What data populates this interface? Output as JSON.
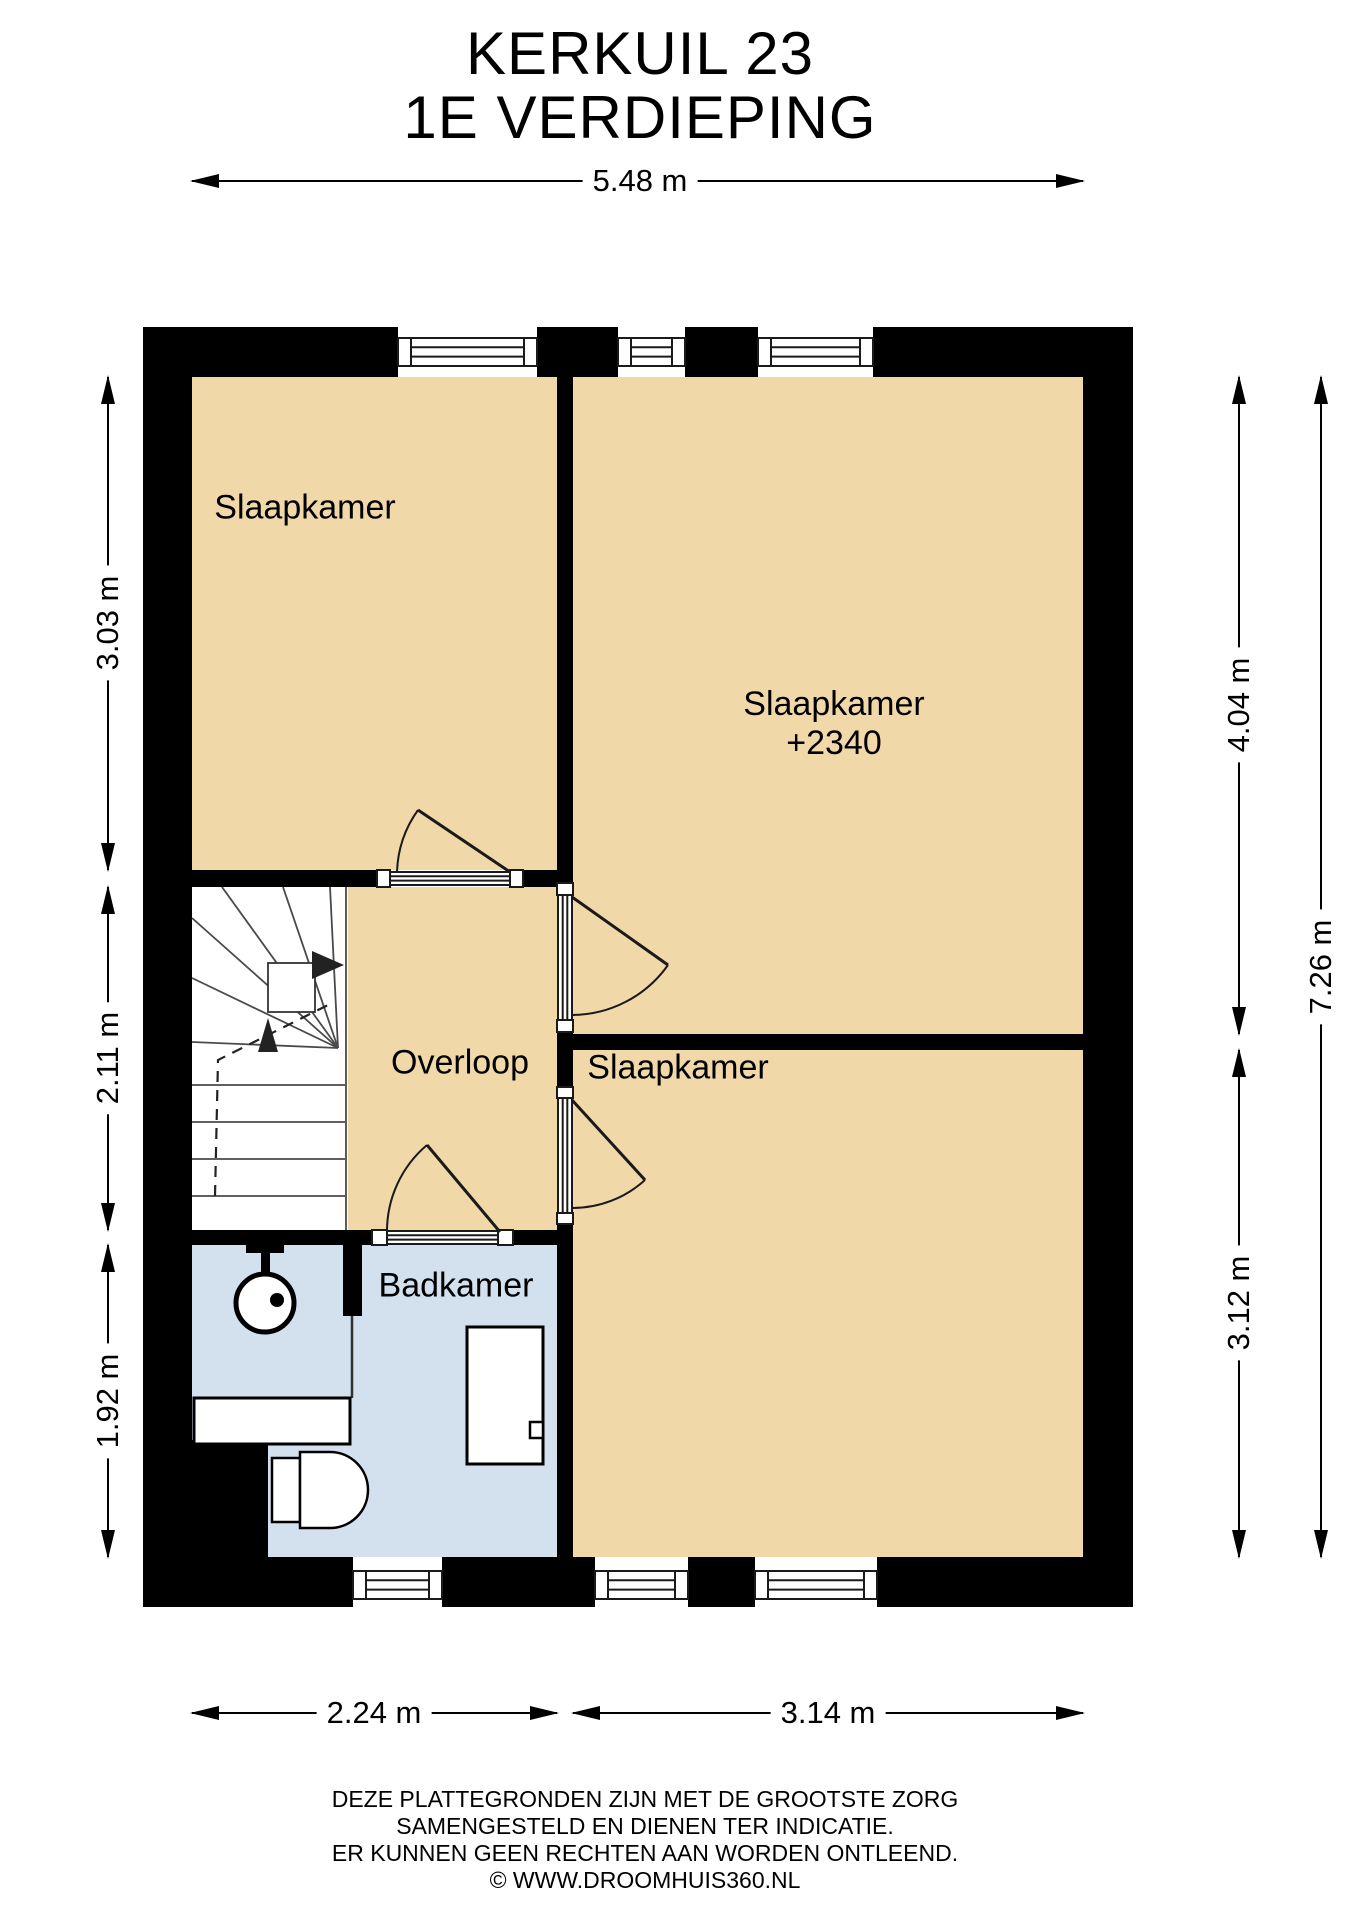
{
  "title": {
    "line1": "KERKUIL 23",
    "line2": "1E VERDIEPING"
  },
  "rooms": {
    "bedroom_top_left": "Slaapkamer",
    "bedroom_right": "Slaapkamer",
    "bedroom_right_note": "+2340",
    "landing": "Overloop",
    "bathroom": "Badkamer",
    "bedroom_bottom": "Slaapkamer"
  },
  "dimensions": {
    "top": "5.48 m",
    "left_upper": "3.03 m",
    "left_middle": "2.11 m",
    "left_lower": "1.92 m",
    "right_upper": "4.04 m",
    "right_lower": "3.12 m",
    "right_total": "7.26 m",
    "bottom_left": "2.24 m",
    "bottom_right": "3.14 m"
  },
  "footer": {
    "line1": "DEZE PLATTEGRONDEN ZIJN MET DE GROOTSTE ZORG",
    "line2": "SAMENGESTELD EN DIENEN TER INDICATIE.",
    "line3": "ER KUNNEN GEEN RECHTEN AAN WORDEN ONTLEEND.",
    "line4": "© WWW.DROOMHUIS360.NL"
  },
  "colors": {
    "room_fill": "#F1D8A9",
    "bathroom_fill": "#D3E0EE",
    "wall": "#000000"
  }
}
